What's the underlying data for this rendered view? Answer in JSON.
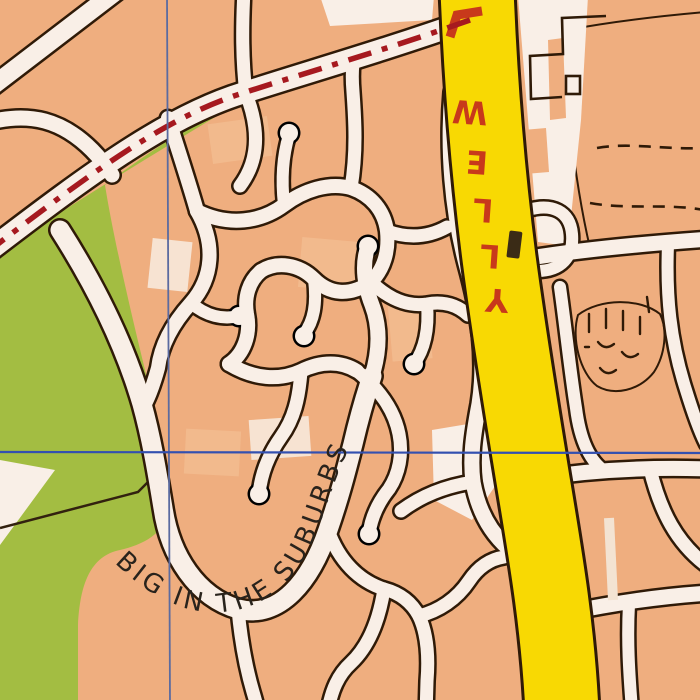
{
  "map": {
    "kind": "suburban-street-map",
    "labels": {
      "main_road_name": "WELLY",
      "main_road_letters": [
        "W",
        "E",
        "L",
        "L",
        "Y"
      ],
      "curved_label": "BIG IN THE SUBURBS"
    },
    "colors": {
      "background_orange": "#EFAE7F",
      "road_fill": "#F9EFE7",
      "road_casing": "#2F1A07",
      "park_green": "#A3BD42",
      "main_road_yellow": "#F8D903",
      "route_dash_red": "#A6191F",
      "road_label_red": "#C8391B",
      "grid_line_blue": "#3350B0",
      "label_black": "#29231C"
    }
  }
}
